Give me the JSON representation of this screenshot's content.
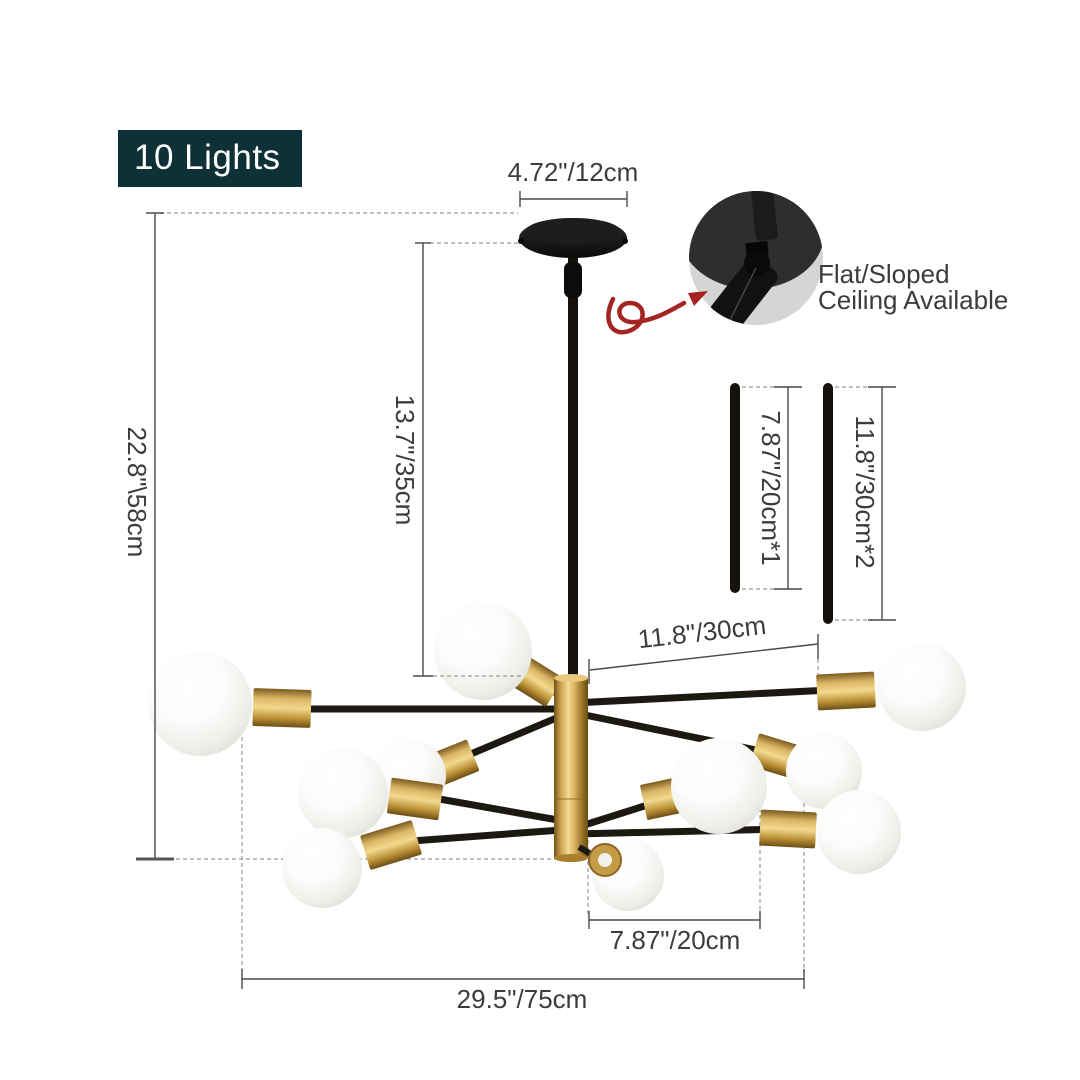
{
  "badge": {
    "label": "10 Lights"
  },
  "callout": {
    "line1": "Flat/Sloped",
    "line2": "Ceiling Available"
  },
  "dimensions": {
    "canopy_width": "4.72\"/12cm",
    "overall_height": "22.8\"\\58cm",
    "rod_height": "13.7\"/35cm",
    "down_rod_short": "7.87\"/20cm*1",
    "down_rod_long": "11.8\"/30cm*2",
    "arm_long": "11.8\"/30cm",
    "arm_short": "7.87\"/20cm",
    "overall_width": "29.5\"/75cm"
  },
  "colors": {
    "background": "#ffffff",
    "badge_background": "#0e3137",
    "badge_text": "#ffffff",
    "brass": "#c99e4a",
    "fixture_black": "#1b1813",
    "bulb_white": "#f6f5f2",
    "dimension_line": "#4a4a4a",
    "dimension_text": "#3c3c3c",
    "arrow_red": "#a32421"
  }
}
